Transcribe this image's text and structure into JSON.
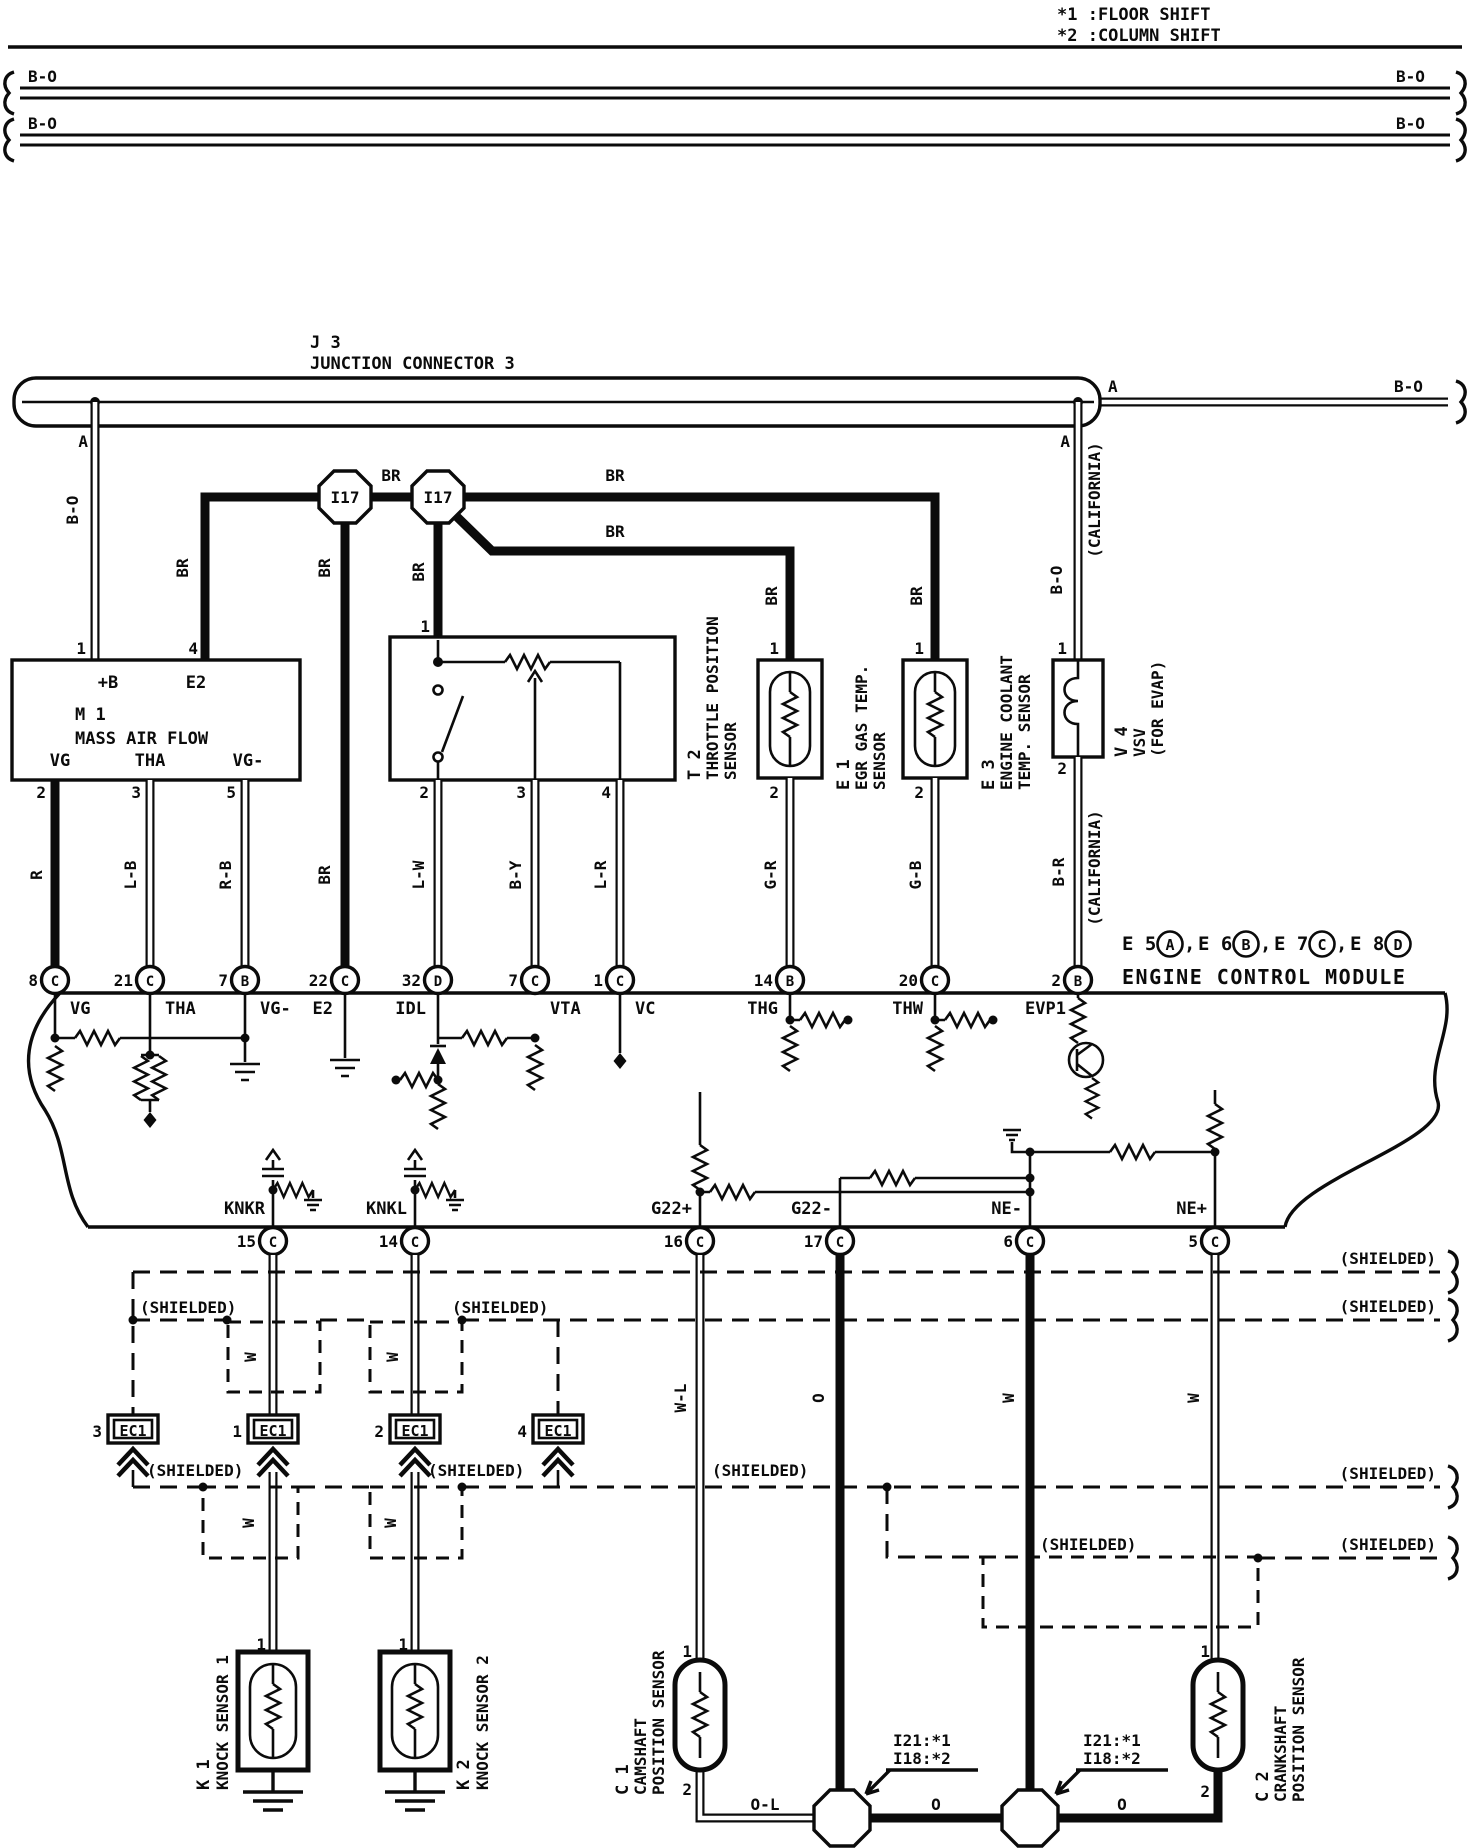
{
  "misc": {
    "note_1": "*1 :FLOOR SHIFT",
    "note_2": "*2 :COLUMN SHIFT",
    "shielded": "(SHIELDED)",
    "california": "(CALIFORNIA)",
    "a": "A"
  },
  "colors": {
    "b_o": "B-O",
    "br": "BR",
    "r": "R",
    "l_b": "L-B",
    "r_b": "R-B",
    "l_w": "L-W",
    "b_y": "B-Y",
    "l_r": "L-R",
    "g_r": "G-R",
    "g_b": "G-B",
    "b_r": "B-R",
    "w": "W",
    "w_l": "W-L",
    "o": "O",
    "o_l": "O-L"
  },
  "j3": {
    "id": "J 3",
    "name": "JUNCTION CONNECTOR 3"
  },
  "i17": {
    "id": "I17"
  },
  "m1": {
    "id": "M 1",
    "name": "MASS AIR FLOW",
    "pin_b": "+B",
    "pin_e2": "E2",
    "pin_vg": "VG",
    "pin_tha": "THA",
    "pin_vg_minus": "VG-",
    "num_b": "1",
    "num_e2": "4",
    "num_vg": "2",
    "num_tha": "3",
    "num_vg_minus": "5"
  },
  "t2": {
    "id": "T 2",
    "name_line1": "THROTTLE POSITION",
    "name_line2": "SENSOR",
    "num1": "1",
    "num2": "2",
    "num3": "3",
    "num4": "4"
  },
  "e1": {
    "id": "E 1",
    "name_line1": "EGR GAS TEMP.",
    "name_line2": "SENSOR",
    "num1": "1",
    "num2": "2"
  },
  "e3": {
    "id": "E 3",
    "name_line1": "ENGINE COOLANT",
    "name_line2": "TEMP. SENSOR",
    "num1": "1",
    "num2": "2"
  },
  "v4": {
    "id": "V 4",
    "name_line1": "VSV",
    "name_line2": "(FOR EVAP)",
    "num1": "1",
    "num2": "2"
  },
  "ecm": {
    "name": "ENGINE CONTROL MODULE",
    "connectors": [
      {
        "id": "E 5",
        "letter": "A",
        "sep": ","
      },
      {
        "id": "E 6",
        "letter": "B",
        "sep": ","
      },
      {
        "id": "E 7",
        "letter": "C",
        "sep": ","
      },
      {
        "id": "E 8",
        "letter": "D",
        "sep": ""
      }
    ],
    "pins_top": [
      {
        "num": "8",
        "letter": "C",
        "label": "VG"
      },
      {
        "num": "21",
        "letter": "C",
        "label": "THA"
      },
      {
        "num": "7",
        "letter": "B",
        "label": "VG-"
      },
      {
        "num": "22",
        "letter": "C",
        "label": "E2"
      },
      {
        "num": "32",
        "letter": "D",
        "label": "IDL"
      },
      {
        "num": "7",
        "letter": "C",
        "label": "VTA"
      },
      {
        "num": "1",
        "letter": "C",
        "label": "VC"
      },
      {
        "num": "14",
        "letter": "B",
        "label": "THG"
      },
      {
        "num": "20",
        "letter": "C",
        "label": "THW"
      },
      {
        "num": "2",
        "letter": "B",
        "label": "EVP1"
      }
    ],
    "pins_bottom": [
      {
        "num": "15",
        "letter": "C",
        "label": "KNKR"
      },
      {
        "num": "14",
        "letter": "C",
        "label": "KNKL"
      },
      {
        "num": "16",
        "letter": "C",
        "label": "G22+"
      },
      {
        "num": "17",
        "letter": "C",
        "label": "G22-"
      },
      {
        "num": "6",
        "letter": "C",
        "label": "NE-"
      },
      {
        "num": "5",
        "letter": "C",
        "label": "NE+"
      }
    ]
  },
  "ec1": {
    "label": "EC1",
    "num_a": "3",
    "num_b": "1",
    "num_c": "2",
    "num_d": "4"
  },
  "k1": {
    "id": "K 1",
    "name": "KNOCK SENSOR 1",
    "num1": "1"
  },
  "k2": {
    "id": "K 2",
    "name": "KNOCK SENSOR 2",
    "num1": "1"
  },
  "c1": {
    "id": "C 1",
    "name_line1": "CAMSHAFT",
    "name_line2": "POSITION SENSOR",
    "num1": "1",
    "num2": "2"
  },
  "c2": {
    "id": "C 2",
    "name_line1": "CRANKSHAFT",
    "name_line2": "POSITION SENSOR",
    "num1": "1",
    "num2": "2"
  },
  "callout": {
    "line1": "I21:*1",
    "line2": "I18:*2"
  }
}
